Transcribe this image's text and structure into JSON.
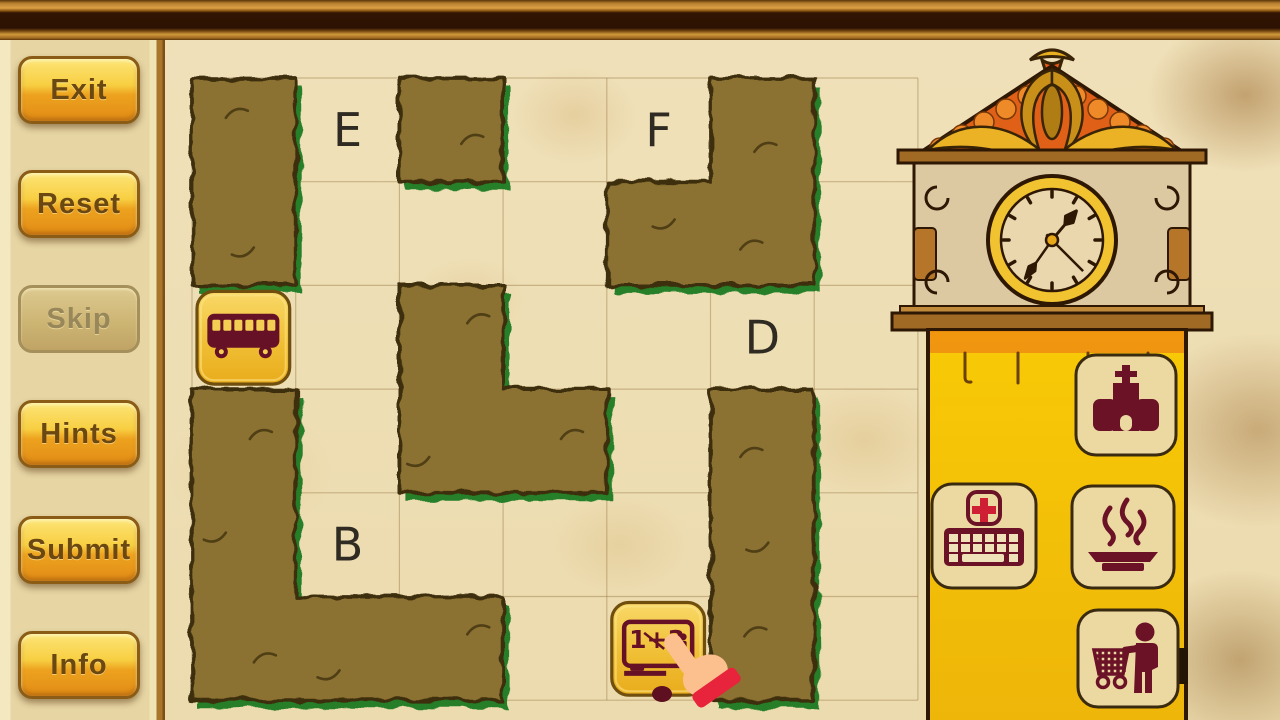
{
  "game": {
    "sidebar": {
      "buttons": [
        {
          "id": "exit",
          "label": "Exit",
          "enabled": true
        },
        {
          "id": "reset",
          "label": "Reset",
          "enabled": true
        },
        {
          "id": "skip",
          "label": "Skip",
          "enabled": false
        },
        {
          "id": "hints",
          "label": "Hints",
          "enabled": true
        },
        {
          "id": "submit",
          "label": "Submit",
          "enabled": true
        },
        {
          "id": "info",
          "label": "Info",
          "enabled": true
        }
      ]
    },
    "board": {
      "grid": {
        "cols": 7,
        "rows": 6,
        "x0": 192,
        "y0": 78,
        "cell": 103.7
      },
      "letters": [
        {
          "label": "E",
          "col": 1,
          "row": 0
        },
        {
          "label": "F",
          "col": 4,
          "row": 0
        },
        {
          "label": "D",
          "col": 5,
          "row": 2
        },
        {
          "label": "B",
          "col": 1,
          "row": 4
        }
      ],
      "hedges": [
        {
          "name": "hedge-top-left",
          "cells": [
            [
              0,
              0
            ],
            [
              0,
              1
            ]
          ],
          "outline": [
            [
              0,
              0
            ],
            [
              1,
              0
            ],
            [
              1,
              2
            ],
            [
              0,
              2
            ]
          ]
        },
        {
          "name": "hedge-top-mid",
          "cells": [
            [
              2,
              0
            ]
          ],
          "outline": [
            [
              2,
              0
            ],
            [
              3,
              0
            ],
            [
              3,
              1
            ],
            [
              2,
              1
            ]
          ]
        },
        {
          "name": "hedge-top-right",
          "cells": [
            [
              5,
              0
            ],
            [
              4,
              1
            ],
            [
              5,
              1
            ]
          ],
          "outline": [
            [
              5,
              0
            ],
            [
              6,
              0
            ],
            [
              6,
              2
            ],
            [
              4,
              2
            ],
            [
              4,
              1
            ],
            [
              5,
              1
            ]
          ]
        },
        {
          "name": "hedge-middle",
          "cells": [
            [
              2,
              2
            ],
            [
              2,
              3
            ],
            [
              3,
              3
            ]
          ],
          "outline": [
            [
              2,
              2
            ],
            [
              3,
              2
            ],
            [
              3,
              3
            ],
            [
              4,
              3
            ],
            [
              4,
              4
            ],
            [
              2,
              4
            ]
          ]
        },
        {
          "name": "hedge-right",
          "cells": [
            [
              5,
              3
            ],
            [
              5,
              4
            ],
            [
              5,
              5
            ]
          ],
          "outline": [
            [
              5,
              3
            ],
            [
              6,
              3
            ],
            [
              6,
              6
            ],
            [
              5,
              6
            ]
          ]
        },
        {
          "name": "hedge-bottom-left",
          "cells": [
            [
              0,
              3
            ],
            [
              0,
              4
            ],
            [
              0,
              5
            ],
            [
              1,
              5
            ],
            [
              2,
              5
            ]
          ],
          "outline": [
            [
              0,
              3
            ],
            [
              1,
              3
            ],
            [
              1,
              5
            ],
            [
              3,
              5
            ],
            [
              3,
              6
            ],
            [
              0,
              6
            ]
          ]
        }
      ],
      "tiles": [
        {
          "name": "bus-tile",
          "icon": "bus",
          "col": 0,
          "row": 2
        },
        {
          "name": "school-tile",
          "icon": "blackboard",
          "icon_text": "1+3",
          "col": 4,
          "row": 5
        }
      ],
      "cursor": {
        "type": "pointing-hand",
        "col": 4,
        "row": 5
      }
    },
    "clock": {
      "hour_angle_deg": 40,
      "minute_angle_deg": 215,
      "second_angle_deg": 135
    },
    "palette": {
      "tiles": [
        {
          "name": "church-tile",
          "icon": "church"
        },
        {
          "name": "medical-keyboard-tile",
          "icon": "keyboard-medical"
        },
        {
          "name": "restaurant-tile",
          "icon": "hot-meal"
        },
        {
          "name": "shopping-tile",
          "icon": "shopping-cart-person"
        }
      ]
    },
    "colors": {
      "hedge": "#8b7232",
      "hedge_outline": "#3c2d0c",
      "hedge_shadow": "#1c7a21",
      "parchment": "#efdfb6",
      "sidebar_bg": "#e7d6a4",
      "button_top": "#fce476",
      "button_bottom": "#e18c16",
      "button_text": "#6b4712",
      "button_disabled_bg": "#cdb574",
      "button_disabled_text": "#97875a",
      "tile_gold_top": "#f9d968",
      "tile_gold_bottom": "#e9ac1c",
      "tile_border": "#6f4e0e",
      "icon_maroon": "#661126",
      "icon_tile_bg": "#ecd9a2",
      "clock_body_yellow": "#f6c40c",
      "clock_wood": "#a06a24",
      "ornament_orange": "#e06018",
      "cross_red": "#cf1f35",
      "sleeve_red": "#e8243c",
      "hand_skin": "#fbc08e",
      "letter_color": "#2f2b22",
      "grid_line": "#8a6a35"
    }
  }
}
